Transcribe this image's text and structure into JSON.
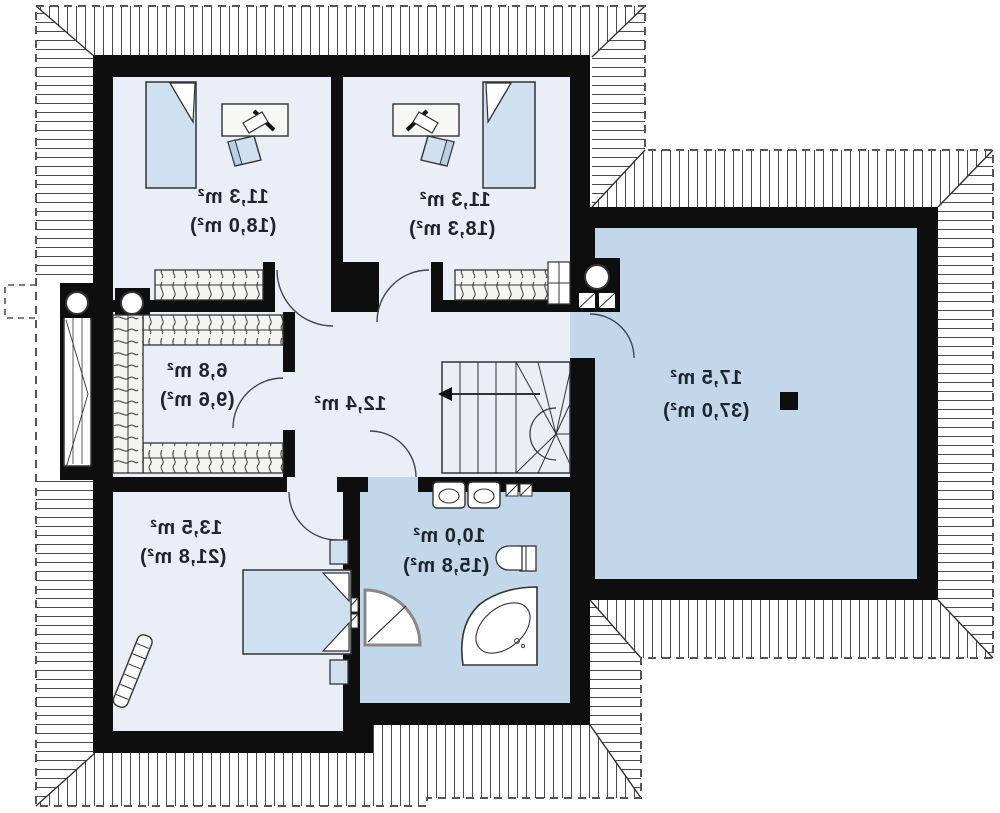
{
  "plan": {
    "type": "floor-plan-upper-storey",
    "mirrored_text": true,
    "colors": {
      "wall": "#0e0e0e",
      "room_light": "#e9eef7",
      "room_medium": "#c3d7eb",
      "furniture_fill": "#cfe0f1",
      "outline": "#333333",
      "label_text": "#20242c",
      "roof_hatch": "#4a4a4a",
      "eaves_dash": "#555555"
    },
    "rooms": [
      {
        "id": "bedroom-top-left",
        "area": "11,3 m²",
        "area_total": "(18,0 m²)"
      },
      {
        "id": "bedroom-top-right",
        "area": "11,3 m²",
        "area_total": "(18,3 m²)"
      },
      {
        "id": "wardrobe",
        "area": "6,8 m²",
        "area_total": "(9,6 m²)"
      },
      {
        "id": "hall",
        "area": "12,4 m²",
        "area_total": ""
      },
      {
        "id": "large-room",
        "area": "17,5 m²",
        "area_total": "(37,0 m²)"
      },
      {
        "id": "bathroom",
        "area": "10,0 m²",
        "area_total": "(15,8 m²)"
      },
      {
        "id": "bedroom-bottom",
        "area": "13,5 m²",
        "area_total": "(21,8 m²)"
      }
    ],
    "symbols": [
      "bed-icon",
      "desk-icon",
      "chair-icon",
      "wardrobe-rack-icon",
      "stairs-icon",
      "door-arc-icon",
      "bathtub-icon",
      "shower-icon",
      "toilet-icon",
      "washbasin-icon",
      "chimney-icon",
      "vent-icon",
      "ladder-icon",
      "column-icon",
      "window-icon"
    ]
  }
}
